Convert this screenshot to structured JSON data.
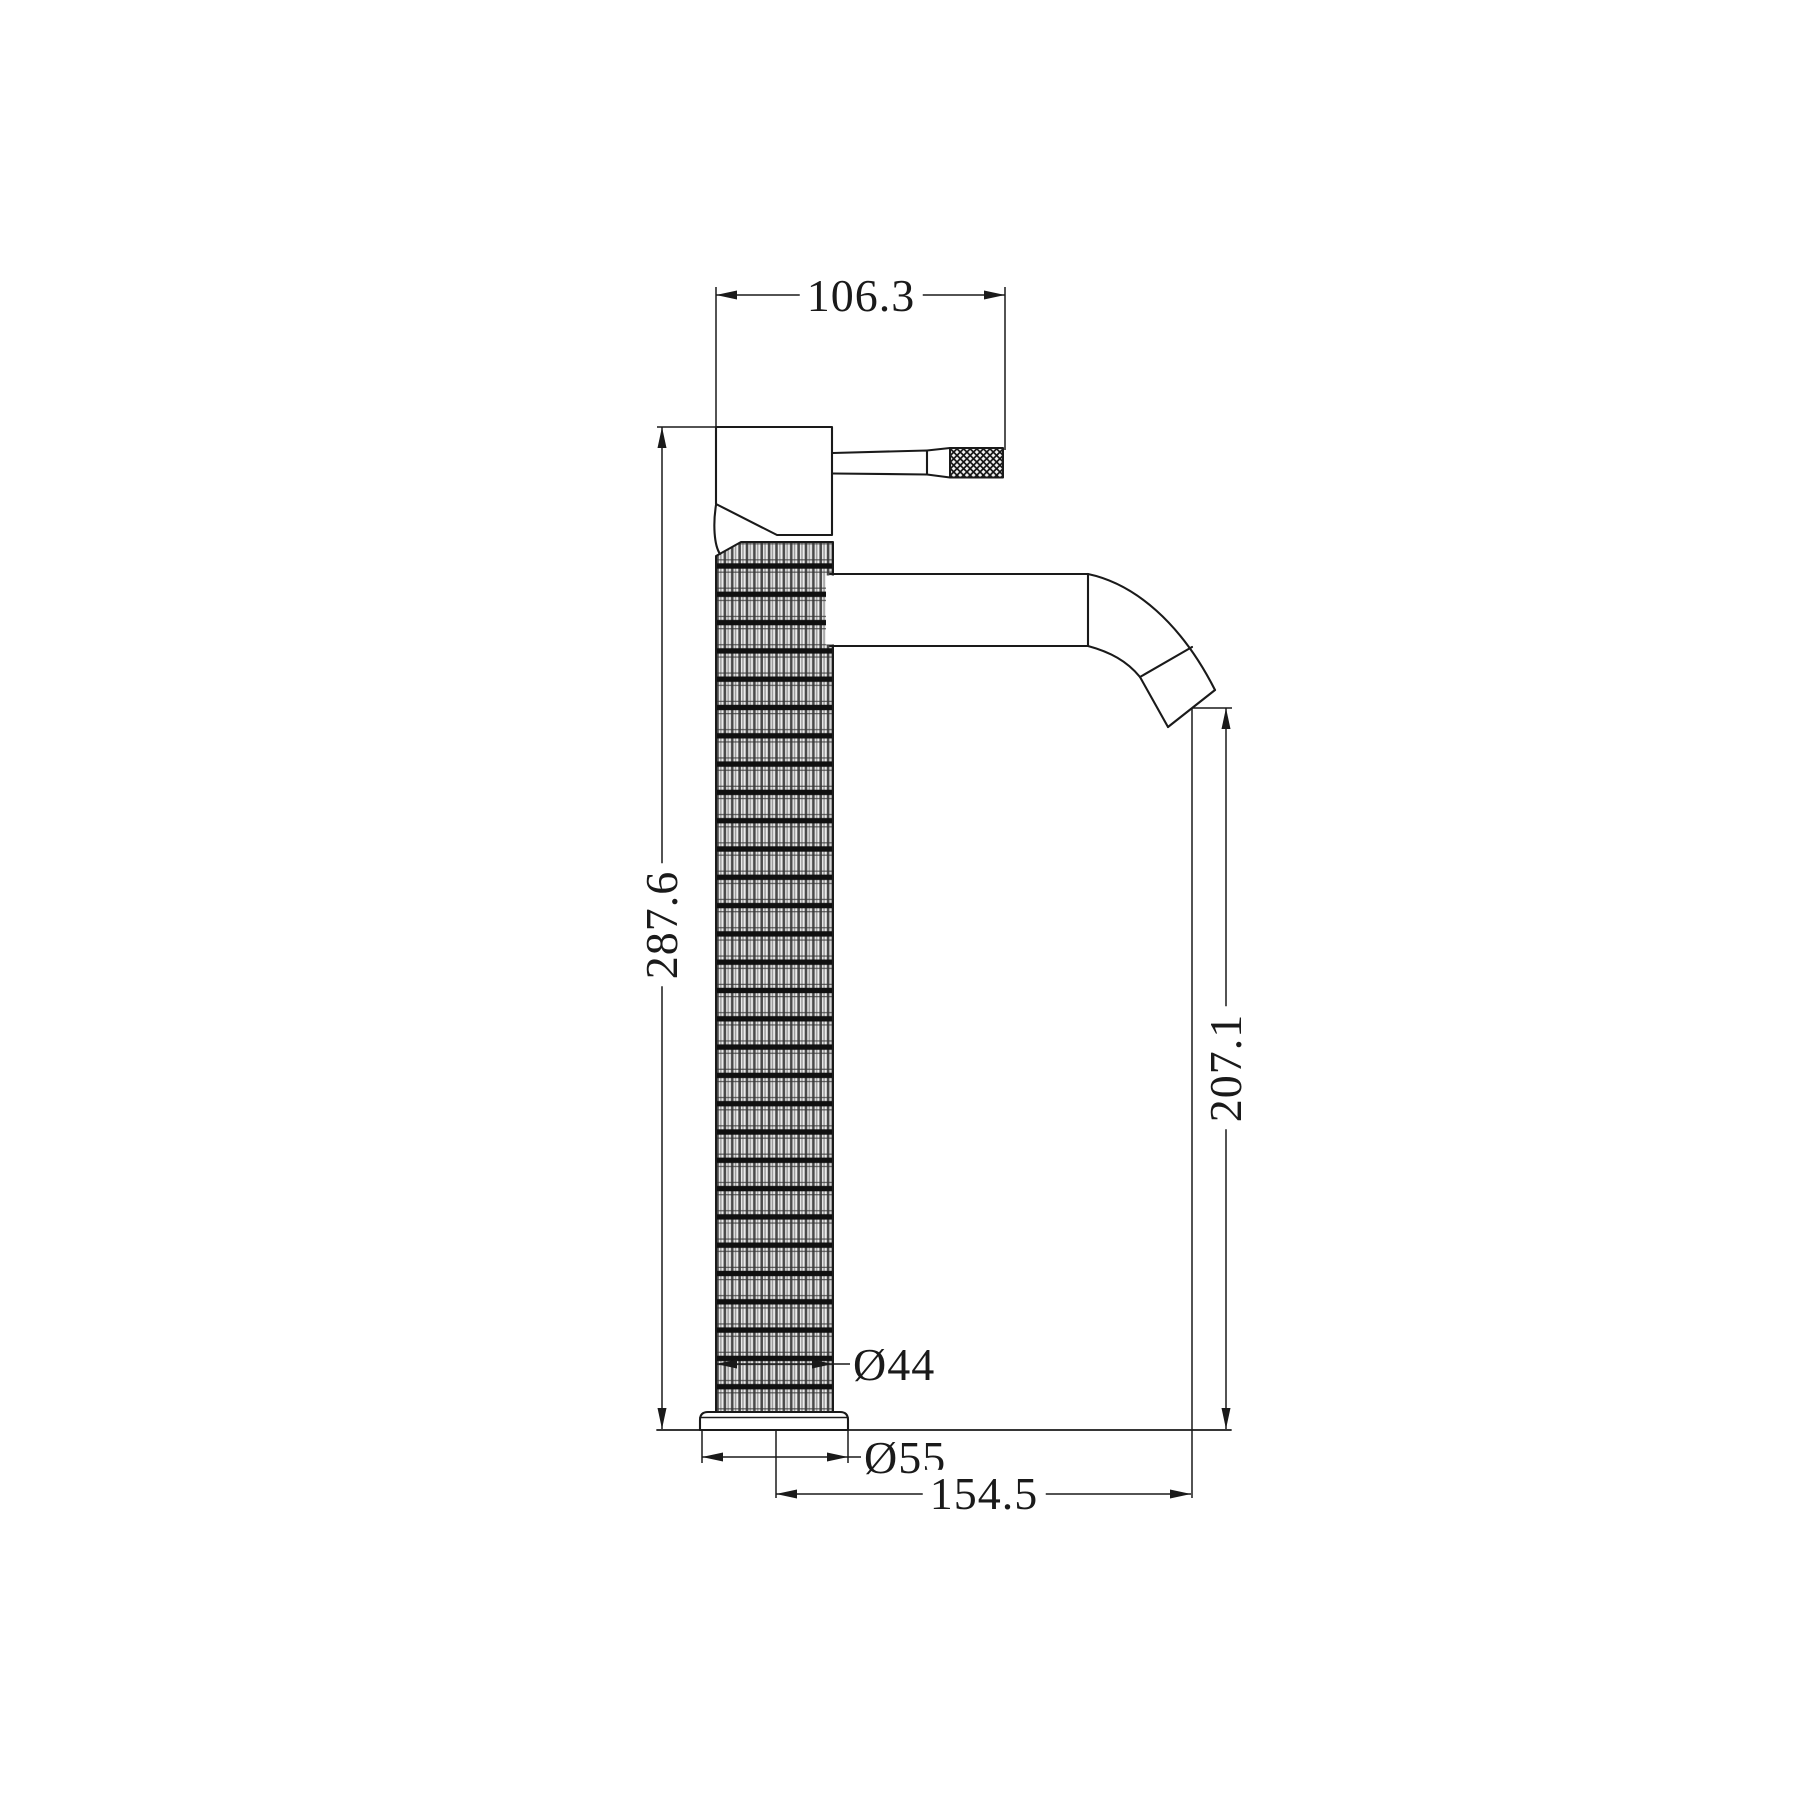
{
  "drawing": {
    "kind": "technical dimension drawing",
    "subject": "tall single-lever basin mixer tap, side elevation",
    "line_color": "#1a1a1a",
    "background_color": "#ffffff",
    "knurl_dark": "#101010",
    "knurl_mid": "#4a4a4a",
    "knurl_light": "#ededed",
    "dimensions": {
      "handle_width": "106.3",
      "overall_height": "287.6",
      "spout_outlet_height": "207.1",
      "body_diameter": "Ø44",
      "base_diameter": "Ø55",
      "spout_reach": "154.5"
    }
  }
}
